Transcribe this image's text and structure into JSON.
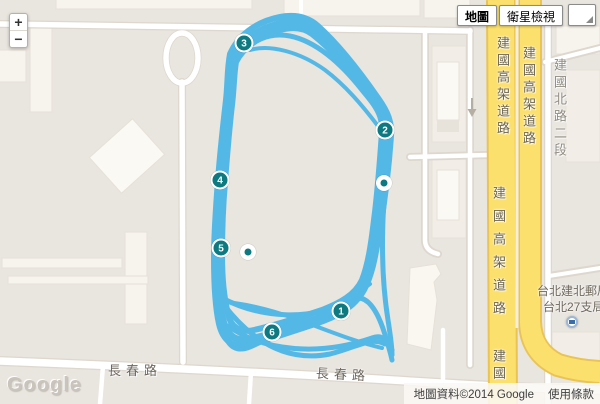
{
  "controls": {
    "zoom_in": "+",
    "zoom_out": "−",
    "map_type_buttons": [
      {
        "label": "地圖",
        "selected": true
      },
      {
        "label": "衛星檢視",
        "selected": false
      }
    ]
  },
  "roads": {
    "jianguo_elevated": "建國高架道路",
    "jianguo_north": "建國北路二段",
    "jianguo_short": "建國",
    "changchun": "長春路"
  },
  "poi": {
    "name_line1": "台北建北郵局",
    "name_line2": "台北27支局",
    "icon": "post-office-icon"
  },
  "logo": "Google",
  "attribution": {
    "copyright": "地圖資料©2014 Google",
    "terms": "使用條款"
  },
  "track": {
    "color": "#54b8e6",
    "paths": [
      {
        "d": "M233,57 C240,42 256,30 278,24 C292,20 303,21 312,27 C332,42 355,68 374,95 C384,109 390,118 389,132 C387,160 385,180 383,205 C381,228 378,240 372,255 C369,272 367,283 359,294 C350,306 335,313 318,319 C295,327 268,335 250,339 C237,342 227,337 223,320 C219,305 217,285 217,260 C217,235 218,210 220,185 C222,158 225,130 228,102 C230,85 230,68 233,57 Z",
        "w": 7
      },
      {
        "d": "M236,62 C243,48 258,36 280,30 C294,26 304,28 312,34 C330,48 352,72 368,96 C378,109 383,118 382,132 C380,160 378,190 374,220 C371,245 368,265 362,280 C355,295 340,303 322,310 C298,318 272,326 254,330 C241,333 231,328 228,314 C224,298 222,278 222,255 C222,230 223,205 225,182 C227,156 229,130 232,105 C234,88 234,73 236,62 Z",
        "w": 6
      },
      {
        "d": "M230,54 C238,36 255,22 280,17 C296,14 308,17 318,26 C338,44 360,72 378,98 C388,112 392,122 391,136 C389,165 385,200 379,235 C375,258 372,275 364,290 C354,308 336,317 315,324 C290,332 265,341 248,345 C233,348 223,341 219,324 C215,306 214,284 214,258 C214,232 216,206 218,180 C220,154 223,126 226,100 C228,82 227,70 230,54 Z",
        "w": 6
      },
      {
        "d": "M234,60 C242,45 258,32 280,27 C293,23 304,25 313,31 C331,46 353,71 370,95 C380,108 386,117 385,131 C383,162 380,195 375,228 C371,252 368,270 361,285 C353,301 338,310 318,317 C294,326 266,340 250,347 C238,352 228,348 224,332 C220,316 219,294 219,268 C219,240 220,212 222,186 C224,158 227,130 230,104 C232,86 232,72 234,60 Z",
        "w": 5
      },
      {
        "d": "M222,298 C260,318 310,322 352,300 C366,292 378,310 386,338 C389,348 391,355 392,360",
        "w": 5
      },
      {
        "d": "M224,305 C255,345 290,362 330,354 C355,348 372,336 385,344",
        "w": 5
      },
      {
        "d": "M228,326 C265,352 320,356 372,338 C382,334 388,340 392,350",
        "w": 5
      },
      {
        "d": "M224,302 C280,306 330,336 382,348",
        "w": 4
      },
      {
        "d": "M248,344 C295,318 335,310 370,284",
        "w": 4
      },
      {
        "d": "M386,170 C382,220 380,270 388,320 C390,333 392,345 392,355",
        "w": 5
      },
      {
        "d": "M236,60 C252,40 268,32 290,36 C315,41 340,62 362,90 C372,102 380,112 384,122",
        "w": 5
      },
      {
        "d": "M250,50 C270,44 300,52 325,70 C345,85 362,105 378,126",
        "w": 4
      }
    ]
  },
  "markers": {
    "fill": "#0c7a80",
    "ring": "#ffffff",
    "numbered": [
      {
        "n": "1",
        "x": 341,
        "y": 311
      },
      {
        "n": "2",
        "x": 385,
        "y": 130
      },
      {
        "n": "3",
        "x": 244,
        "y": 43
      },
      {
        "n": "4",
        "x": 220,
        "y": 180
      },
      {
        "n": "5",
        "x": 221,
        "y": 248
      },
      {
        "n": "6",
        "x": 272,
        "y": 332
      }
    ],
    "dots": [
      {
        "x": 384,
        "y": 183
      },
      {
        "x": 248,
        "y": 252
      }
    ]
  }
}
